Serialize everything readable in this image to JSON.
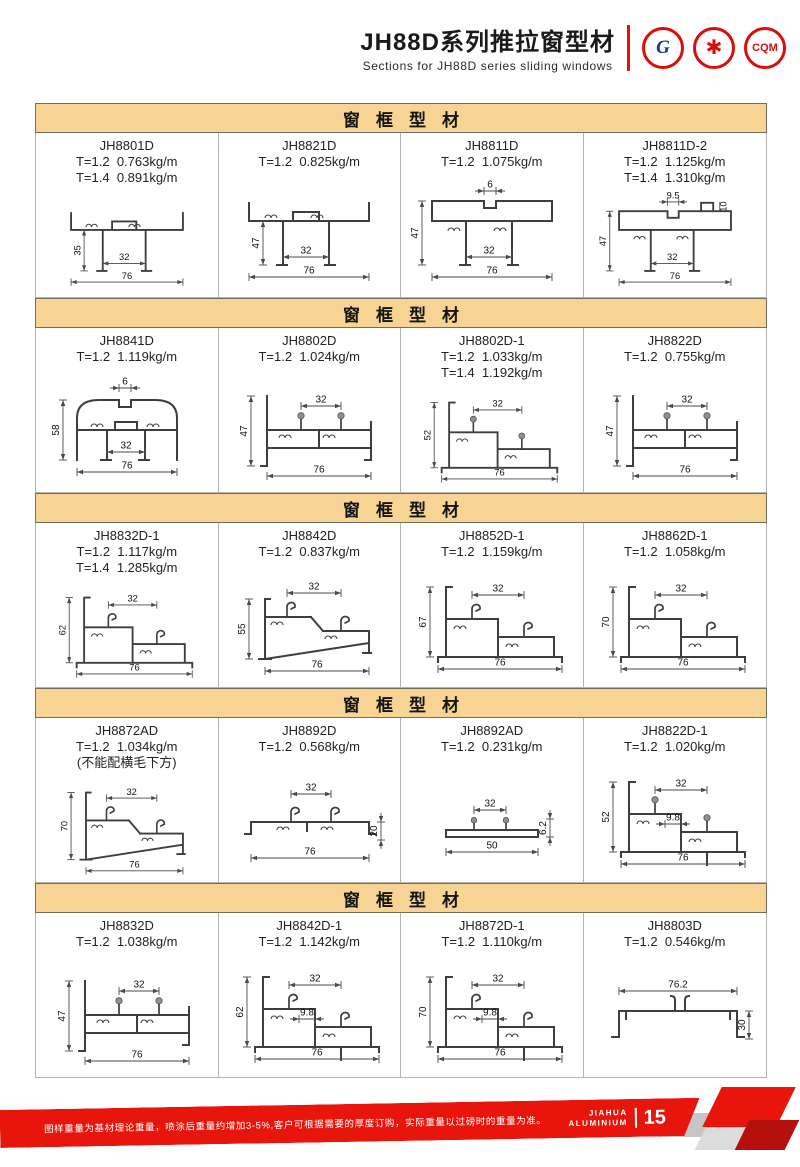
{
  "header": {
    "title": "JH88D系列推拉窗型材",
    "subtitle": "Sections for JH88D series sliding windows",
    "certs": [
      {
        "id": "gb",
        "label": "G"
      },
      {
        "id": "star",
        "label": "✱"
      },
      {
        "id": "cqm",
        "label": "CQM"
      }
    ]
  },
  "sections": [
    {
      "title": "窗框型材",
      "cells": [
        {
          "code": "JH8801D",
          "specs": [
            "T=1.2  0.763kg/m",
            "T=1.4  0.891kg/m"
          ],
          "shape": "rail",
          "dims": {
            "h": "35",
            "i": "32",
            "w": "76"
          }
        },
        {
          "code": "JH8821D",
          "specs": [
            "T=1.2  0.825kg/m"
          ],
          "shape": "rail",
          "dims": {
            "h": "47",
            "i": "32",
            "w": "76"
          }
        },
        {
          "code": "JH8811D",
          "specs": [
            "T=1.2  1.075kg/m"
          ],
          "shape": "boxtop",
          "dims": {
            "t": "6",
            "h": "47",
            "i": "32",
            "w": "76"
          }
        },
        {
          "code": "JH8811D-2",
          "specs": [
            "T=1.2  1.125kg/m",
            "T=1.4  1.310kg/m"
          ],
          "shape": "boxtop",
          "dims": {
            "t": "9.5",
            "tab": "10",
            "h": "47",
            "i": "32",
            "w": "76"
          }
        }
      ]
    },
    {
      "title": "窗框型材",
      "cells": [
        {
          "code": "JH8841D",
          "specs": [
            "T=1.2  1.119kg/m"
          ],
          "shape": "dome",
          "dims": {
            "t": "6",
            "h": "58",
            "i": "32",
            "w": "76"
          }
        },
        {
          "code": "JH8802D",
          "specs": [
            "T=1.2  1.024kg/m"
          ],
          "shape": "flatpins",
          "dims": {
            "h": "47",
            "i": "32",
            "w": "76"
          }
        },
        {
          "code": "JH8802D-1",
          "specs": [
            "T=1.2  1.033kg/m",
            "T=1.4  1.192kg/m"
          ],
          "shape": "step-pins",
          "dims": {
            "h": "52",
            "i": "32",
            "w": "76"
          }
        },
        {
          "code": "JH8822D",
          "specs": [
            "T=1.2  0.755kg/m"
          ],
          "shape": "flatpins",
          "dims": {
            "h": "47",
            "i": "32",
            "w": "76"
          }
        }
      ]
    },
    {
      "title": "窗框型材",
      "cells": [
        {
          "code": "JH8832D-1",
          "specs": [
            "T=1.2  1.117kg/m",
            "T=1.4  1.285kg/m"
          ],
          "shape": "step-hooks",
          "dims": {
            "h": "62",
            "i": "32",
            "w": "76"
          }
        },
        {
          "code": "JH8842D",
          "specs": [
            "T=1.2  0.837kg/m"
          ],
          "shape": "slope-short",
          "dims": {
            "h": "55",
            "i": "32",
            "w": "76"
          }
        },
        {
          "code": "JH8852D-1",
          "specs": [
            "T=1.2  1.159kg/m"
          ],
          "shape": "step-hooks",
          "dims": {
            "h": "67",
            "i": "32",
            "w": "76"
          }
        },
        {
          "code": "JH8862D-1",
          "specs": [
            "T=1.2  1.058kg/m"
          ],
          "shape": "step-hooks",
          "dims": {
            "h": "70",
            "i": "32",
            "w": "76"
          }
        }
      ]
    },
    {
      "title": "窗框型材",
      "cells": [
        {
          "code": "JH8872AD",
          "specs": [
            "T=1.2  1.034kg/m",
            "(不能配横毛下方)"
          ],
          "shape": "slope",
          "dims": {
            "h": "70",
            "i": "32",
            "w": "76"
          }
        },
        {
          "code": "JH8892D",
          "specs": [
            "T=1.2  0.568kg/m"
          ],
          "shape": "lowflat",
          "dims": {
            "i": "32",
            "r": "20",
            "w": "76"
          }
        },
        {
          "code": "JH8892AD",
          "specs": [
            "T=1.2  0.231kg/m"
          ],
          "shape": "bar",
          "dims": {
            "i": "32",
            "r": "6.2",
            "w": "50"
          }
        },
        {
          "code": "JH8822D-1",
          "specs": [
            "T=1.2  1.020kg/m"
          ],
          "shape": "step-pins-9",
          "dims": {
            "h": "52",
            "i": "32",
            "n": "9.8",
            "w": "76"
          }
        }
      ]
    },
    {
      "title": "窗框型材",
      "cells": [
        {
          "code": "JH8832D",
          "specs": [
            "T=1.2  1.038kg/m"
          ],
          "shape": "flatpins",
          "dims": {
            "h": "47",
            "i": "32",
            "w": "76"
          }
        },
        {
          "code": "JH8842D-1",
          "specs": [
            "T=1.2  1.142kg/m"
          ],
          "shape": "step-hooks-9",
          "dims": {
            "h": "62",
            "i": "32",
            "n": "9.8",
            "w": "76"
          }
        },
        {
          "code": "JH8872D-1",
          "specs": [
            "T=1.2  1.110kg/m"
          ],
          "shape": "step-hooks-9",
          "dims": {
            "h": "70",
            "i": "32",
            "n": "9.8",
            "w": "76"
          }
        },
        {
          "code": "JH8803D",
          "specs": [
            "T=1.2  0.546kg/m"
          ],
          "shape": "channel",
          "dims": {
            "t": "76.2",
            "r": "30"
          }
        }
      ]
    }
  ],
  "footer": {
    "note": "图样重量为基材理论重量，喷涂后重量约增加3-5%,客户可根据需要的厚度订购，实际重量以过磅时的重量为准。",
    "brand_top": "JIAHUA",
    "brand_bottom": "ALUMINIUM",
    "page": "15"
  },
  "colors": {
    "accent_red": "#e8150d",
    "band_bg": "#f7d494",
    "grid_line": "#b3b3b3",
    "drawing_line": "#3e3e3e"
  }
}
